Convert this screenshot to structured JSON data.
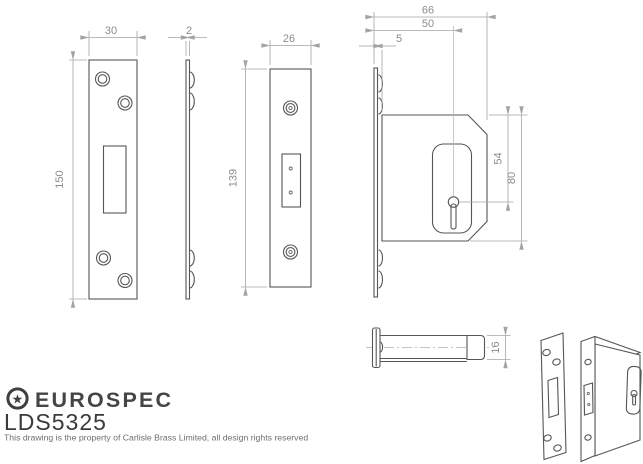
{
  "logo": {
    "star_glyph": "★",
    "brand": "EUROSPEC",
    "model": "LDS5325",
    "copyright": "This drawing is the property of Carlisle Brass Limited, all design rights reserved"
  },
  "dims": {
    "faceplate_front": {
      "width": "30",
      "height": "150"
    },
    "faceplate_edge": {
      "thickness": "2"
    },
    "forend_front": {
      "width": "26",
      "height": "139"
    },
    "case_side": {
      "overall_depth": "66",
      "backset": "50",
      "faceplate_to_case": "5",
      "top_to_keyhole": "54",
      "case_height": "80"
    },
    "bolt_side": {
      "bolt_height": "16"
    }
  },
  "colors": {
    "outline": "#565656",
    "dim_line": "#a3a3a3",
    "dim_text": "#8c8c8c",
    "logo": "#3f3f3f",
    "muted_text": "#6f6f6f",
    "background": "#ffffff"
  }
}
